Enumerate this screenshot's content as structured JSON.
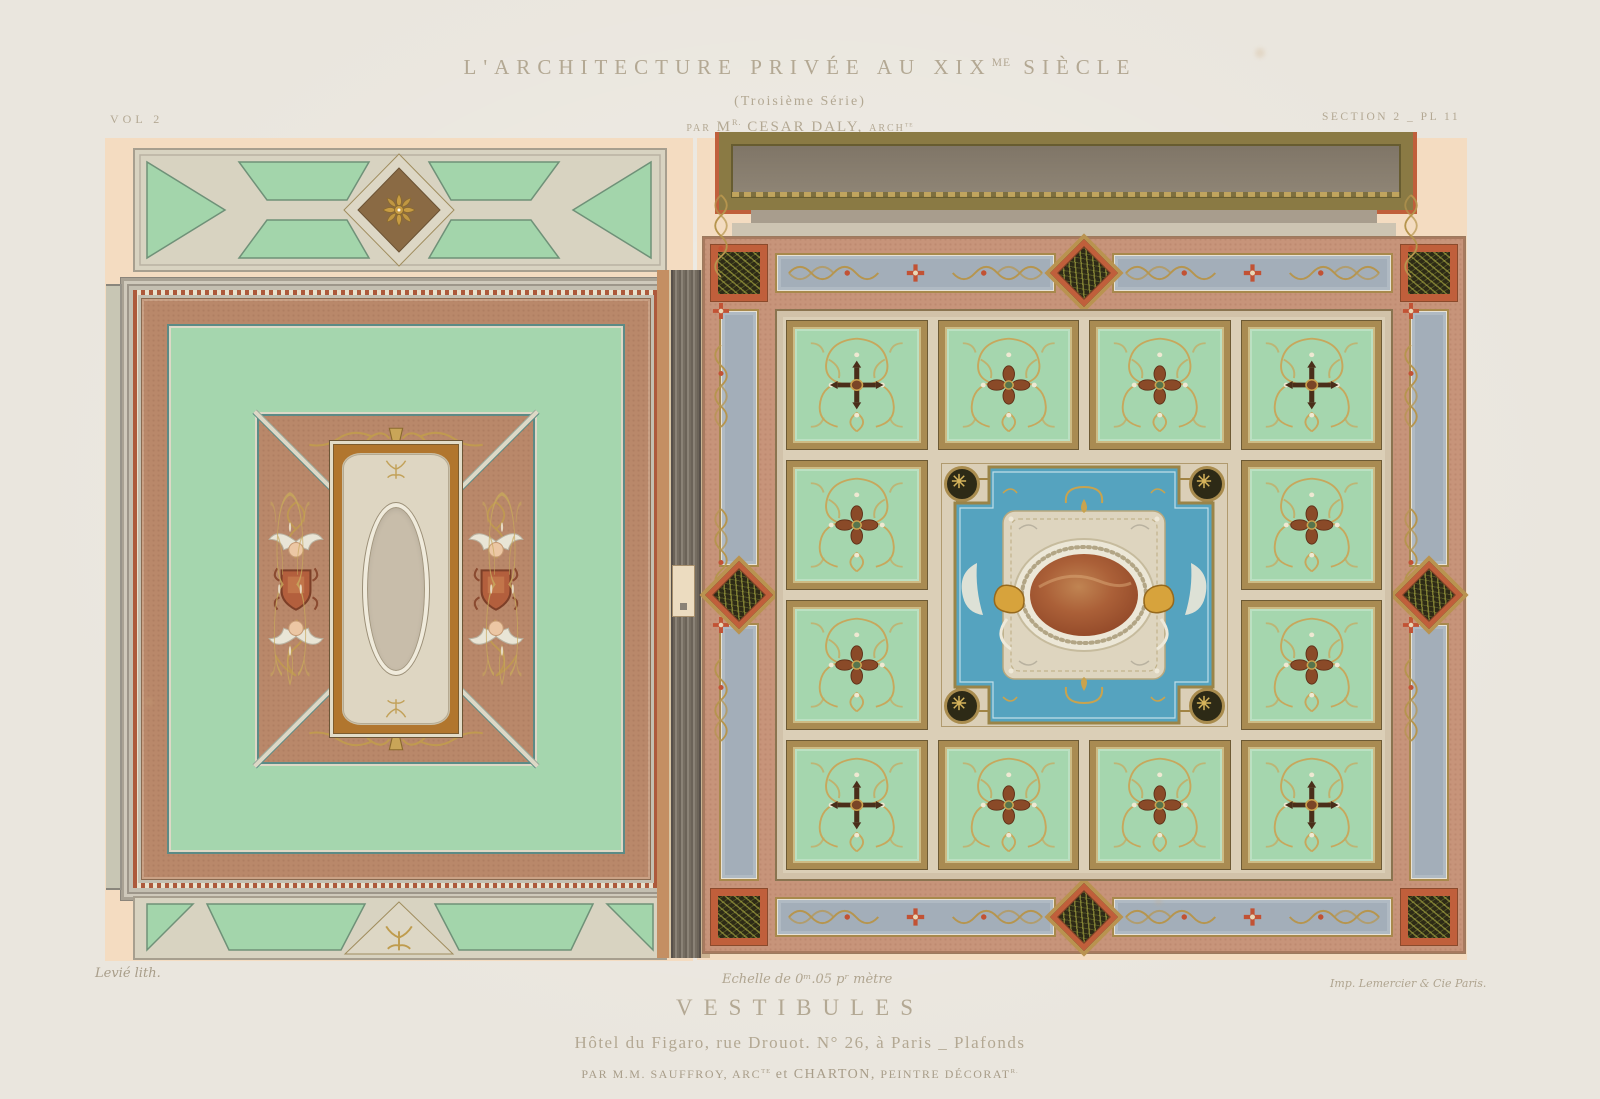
{
  "header": {
    "vol": "VOL 2",
    "title_main": "L'ARCHITECTURE PRIVÉE AU XIX",
    "title_sup": "ME",
    "title_tail": " SIÈCLE",
    "subtitle": "(Troisième Série)",
    "byline_par": "PAR",
    "byline_m": "M",
    "byline_m_sup": "R.",
    "byline_name": "CESAR DALY,",
    "byline_arch": "ARCH",
    "byline_arch_sup": "TE",
    "section": "SECTION 2 _ PL 11"
  },
  "footer": {
    "lith_credit": "Levié lith.",
    "scale": "Echelle de 0ᵐ.05 pʳ mètre",
    "printer_credit": "Imp. Lemercier & Cie Paris.",
    "title": "VESTIBULES",
    "subtitle": "Hôtel du Figaro, rue Drouot. N° 26, à Paris _ Plafonds",
    "credits_par": "PAR M.M. SAUFFROY,",
    "credits_arch": "ARC",
    "credits_arch_sup": "TE",
    "credits_et": "et CHARTON,",
    "credits_peintre": "PEINTRE DÉCORAT",
    "credits_peintre_sup": "R."
  },
  "palette": {
    "paper": "#eae6de",
    "peach": "#f4dcc1",
    "ink": "#b3a893",
    "mint": "#a5d6ae",
    "teal": "#5c8b86",
    "cream": "#dcd6c3",
    "rosybrown": "#b9886a",
    "amber": "#b1762e",
    "gold": "#b99350",
    "goldline": "#a18444",
    "darkbrown": "#4a2e1a",
    "bluegray": "#a3aeb9",
    "turquoise": "#55a3bf",
    "redorange": "#c05f3b",
    "blackgreen": "#2d2a16",
    "dustyrose": "#c7947a",
    "fieldcream": "#dbcfb7",
    "olive": "#8a7a44",
    "panelgray": "#8d8272",
    "russet": "#a55a36",
    "shield": "#b35f3d",
    "cartouche": "#ded6c2",
    "ovalfill": "#c8bdaa"
  },
  "right_ceiling": {
    "coffer_motifs": [
      "cross",
      "quatrefoil",
      "quatrefoil",
      "cross",
      "quatrefoil",
      "quatrefoil",
      "quatrefoil",
      "quatrefoil",
      "cross",
      "quatrefoil",
      "quatrefoil",
      "cross"
    ]
  }
}
